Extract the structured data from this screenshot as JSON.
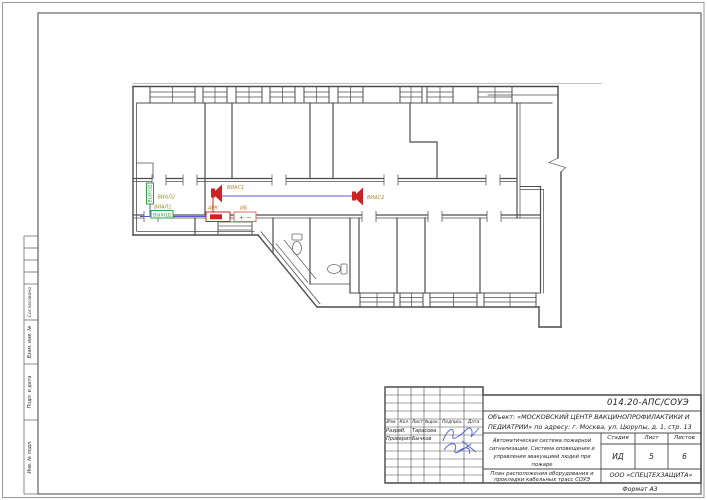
{
  "sheet": {
    "format_label": "Формат А3"
  },
  "side_strip": {
    "sections": [
      {
        "label": "Согласовано"
      },
      {
        "label": "Взам. инв. №"
      },
      {
        "label": "Подп. и дата"
      },
      {
        "label": "Инв. № подл."
      }
    ]
  },
  "title_block": {
    "code": "014.20-АПС/СОУЭ",
    "object": "Объект: «МОСКОВСКИЙ ЦЕНТР ВАКЦИНОПРОФИЛАКТИКИ И ПЕДИАТРИИ» по адресу: г. Москва, ул. Цюрупы, д. 1, стр. 13",
    "system_description": "Автоматическая система пожарной сигнализации. Система оповещения и управления эвакуацией людей при пожаре",
    "sheet_title": "План расположения оборудования и прокладки кабельных трасс СОУЭ",
    "company": "ООО «СПЕЦТЕХЗАЩИТА»",
    "columns": [
      "Изм.",
      "Кол.",
      "Лист",
      "№док.",
      "Подпись",
      "Дата"
    ],
    "rows": [
      {
        "role": "Разраб.",
        "name": "Тарасова"
      },
      {
        "role": "Проверил",
        "name": "Бычков"
      }
    ],
    "stage_label": "Стадия",
    "sheet_label": "Лист",
    "sheets_label": "Листов",
    "stage": "ИД",
    "sheet_no": "5",
    "sheets_total": "6"
  },
  "plan": {
    "devices": [
      {
        "id": "ВИАЛ2",
        "type": "exit-light-sign",
        "text": "ВЫХОД"
      },
      {
        "id": "ВИАЛ1",
        "type": "exit-light-sign",
        "text": "ВЫХОД"
      },
      {
        "id": "ВИАС1",
        "type": "sound-annunciator"
      },
      {
        "id": "ВИАС2",
        "type": "sound-annunciator"
      },
      {
        "id": "АРК",
        "type": "junction-box"
      },
      {
        "id": "ИБ",
        "type": "power-supply",
        "text": "+ −"
      }
    ],
    "colors": {
      "wall": "#4d4d4d",
      "cable_blue": "#5a5ad0",
      "alarm_red": "#cc2222",
      "exit_green": "#2fa043",
      "device_label": "#b9832f",
      "signature_blue": "#3550c8"
    }
  }
}
